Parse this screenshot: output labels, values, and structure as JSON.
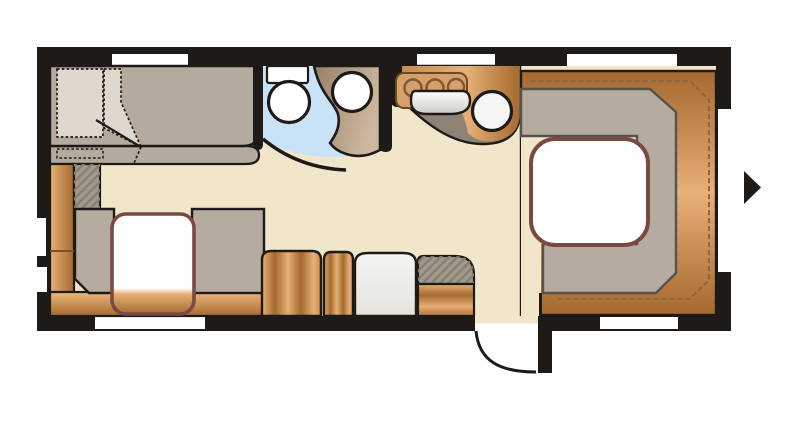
{
  "document": {
    "title": "Caravan floor plan",
    "kind": "floor-plan-diagram"
  },
  "rooms": [
    {
      "id": "bedroom",
      "label": "bed"
    },
    {
      "id": "washroom",
      "label": "washroom"
    },
    {
      "id": "kitchen",
      "label": "kitchen"
    },
    {
      "id": "side-dinette",
      "label": "side dinette"
    },
    {
      "id": "rear-lounge",
      "label": "u-shaped rear lounge"
    }
  ],
  "fixtures": [
    "double-bed",
    "duvet-fold",
    "wardrobe",
    "mirror-cabinet",
    "toilet",
    "cistern",
    "washbasin",
    "basin-cabinet",
    "washroom-door-arc",
    "hob-3-burner",
    "sink-round",
    "sink-cover",
    "kitchen-counter",
    "side-seat-left",
    "side-seat-right",
    "side-table",
    "bench-base",
    "cabinet-wood-wide",
    "cabinet-wood-narrow",
    "fridge",
    "cabinet-entry",
    "entry-door-leaf",
    "entry-door-arc",
    "lounge-seat-u",
    "lounge-backrest-wood",
    "lounge-table",
    "direction-arrow"
  ],
  "windows": {
    "top": 3,
    "bottom": 2,
    "right": 1,
    "left": 2
  },
  "door": {
    "type": "entry-door",
    "state": "open",
    "swing": "outward"
  },
  "arrow": {
    "meaning": "entrance-side-marker",
    "direction": "right"
  },
  "colors": {
    "wall": "#1d1a17",
    "floor": "#f2e6ca",
    "window": "#ffffff",
    "bed": "#b4aa9d",
    "duvet": "#ded8ce",
    "seat": "#b5ab9e",
    "seat_outline": "#57534c",
    "table_border": "#7a4a42",
    "table_top": "#ffffff",
    "bathroom_floor": "#c9e2f5",
    "fixture_white": "#ffffff",
    "counter_front": "#8d8274",
    "hatch_base": "#a19a8c",
    "hatch_stripe": "#87806f",
    "stitch": "#8a6742",
    "stove_top": "#d5a069",
    "stove_edge": "#6b4a28",
    "burner_ring": "#7c5832",
    "fridge_light": "#f6f5f2",
    "fridge_shade": "#e6e3dc",
    "wood_light": "#e6b076",
    "wood_mid": "#c98c50",
    "wood_dark": "#a5692f",
    "basin_light": "#ccb99f",
    "basin_dark": "#96806a",
    "lid_shade": "#cfccc6",
    "arrow": "#1d1a17"
  }
}
